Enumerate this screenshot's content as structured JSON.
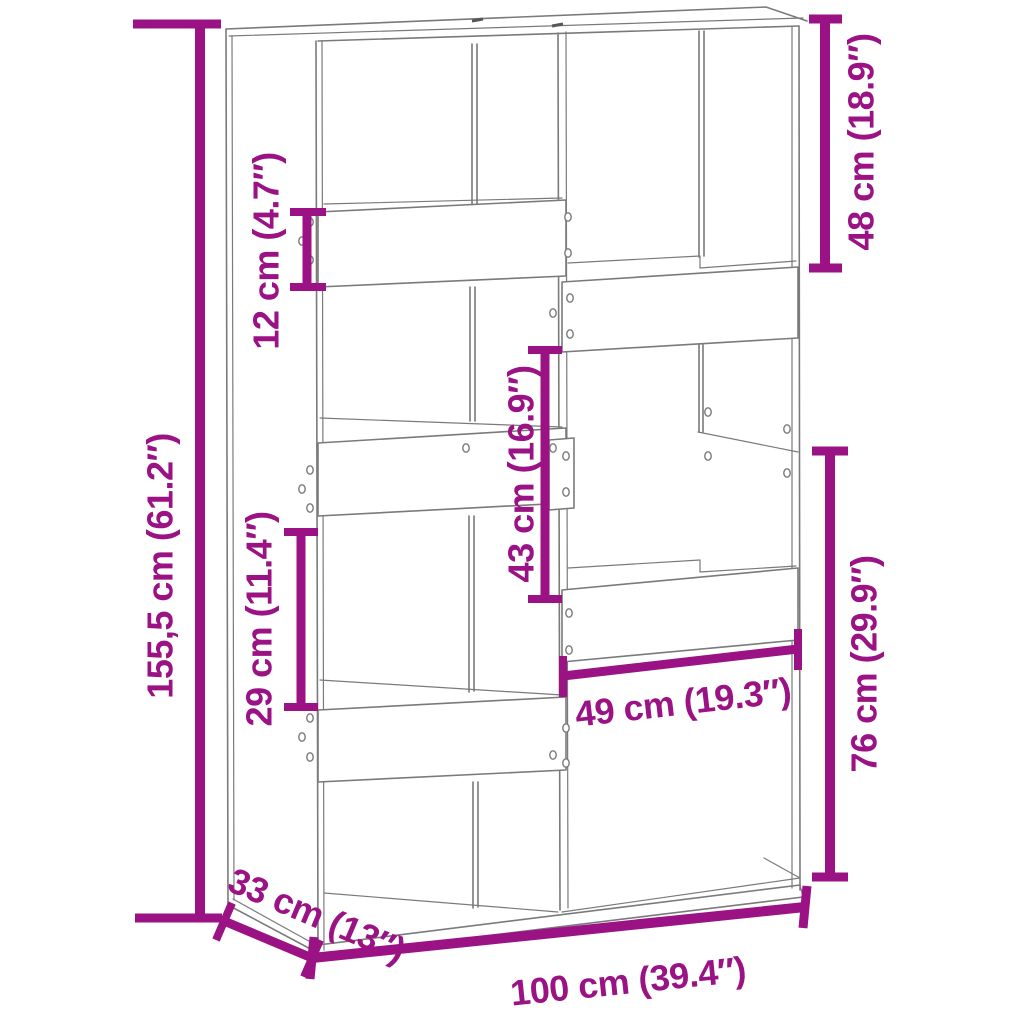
{
  "diagram": {
    "title": "bookcase-room-divider-dimension-diagram",
    "background": "#ffffff",
    "accent_color": "#9a1283",
    "drawing_line_color": "#7a7a7a",
    "labels": {
      "total_height": "155,5 cm (61.2″)",
      "top_shelf_board_height": "12 cm (4.7″)",
      "top_right_compartment_height": "48 cm (18.9″)",
      "middle_compartment_height": "43 cm (16.9″)",
      "lower_left_compartment_height": "29 cm (11.4″)",
      "lower_right_section_height": "76 cm (29.9″)",
      "lower_right_compartment_width": "49 cm (19.3″)",
      "depth": "33 cm (13″)",
      "width": "100 cm (39.4″)"
    }
  }
}
